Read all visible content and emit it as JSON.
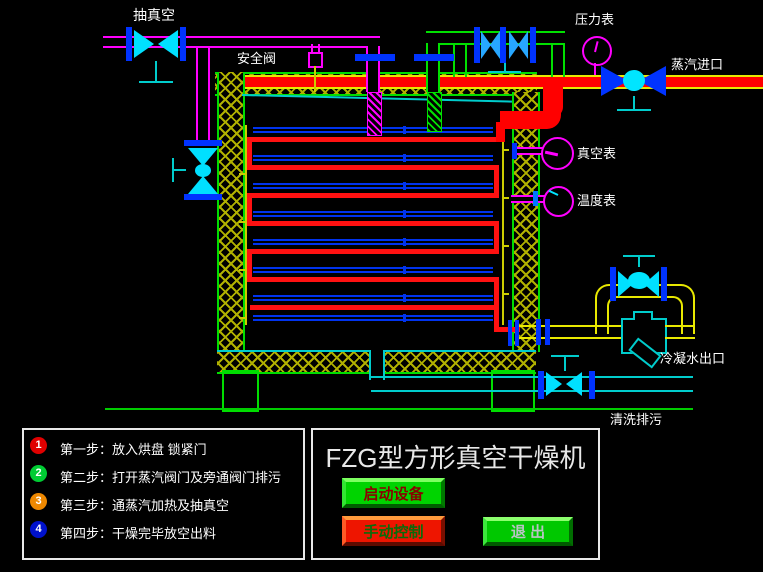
{
  "labels": {
    "vacuum_line": "抽真空",
    "safety_valve": "安全阀",
    "pressure_gauge": "压力表",
    "steam_inlet": "蒸汽进口",
    "vacuum_gauge": "真空表",
    "temperature_gauge": "温度表",
    "condensate_outlet": "冷凝水出口",
    "wash_drain": "清洗排污"
  },
  "steps_panel": {
    "items": [
      {
        "num": "1",
        "color": "#e00000",
        "text": "第一步：放入烘盘 锁紧门"
      },
      {
        "num": "2",
        "color": "#00cc33",
        "text": "第二步：打开蒸汽阀门及旁通阀门排污"
      },
      {
        "num": "3",
        "color": "#ee8800",
        "text": "第三步：通蒸汽加热及抽真空"
      },
      {
        "num": "4",
        "color": "#0011cc",
        "text": "第四步：干燥完毕放空出料"
      }
    ]
  },
  "control_panel": {
    "title": "FZG型方形真空干燥机",
    "buttons": [
      {
        "label": "启动设备",
        "color": "#00d400",
        "text_color": "#8b0000"
      },
      {
        "label": "手动控制",
        "color": "#ee1500",
        "text_color": "#0a6b0a"
      },
      {
        "label": "退  出",
        "color": "#00c800",
        "text_color": "#b9c4c4"
      }
    ]
  },
  "colors": {
    "background": "#000000",
    "pipe_vacuum": "#ff00ff",
    "pipe_steam": "#ff0000",
    "pipe_bypass": "#00e000",
    "pipe_condensate": "#e8e800",
    "pipe_drain": "#00cccc",
    "insulation_hatch": "#b0b000",
    "structure": "#00dd00",
    "flange": "#0033ff",
    "tray": "#0033ee",
    "gauge_ring": "#ff00ff"
  }
}
